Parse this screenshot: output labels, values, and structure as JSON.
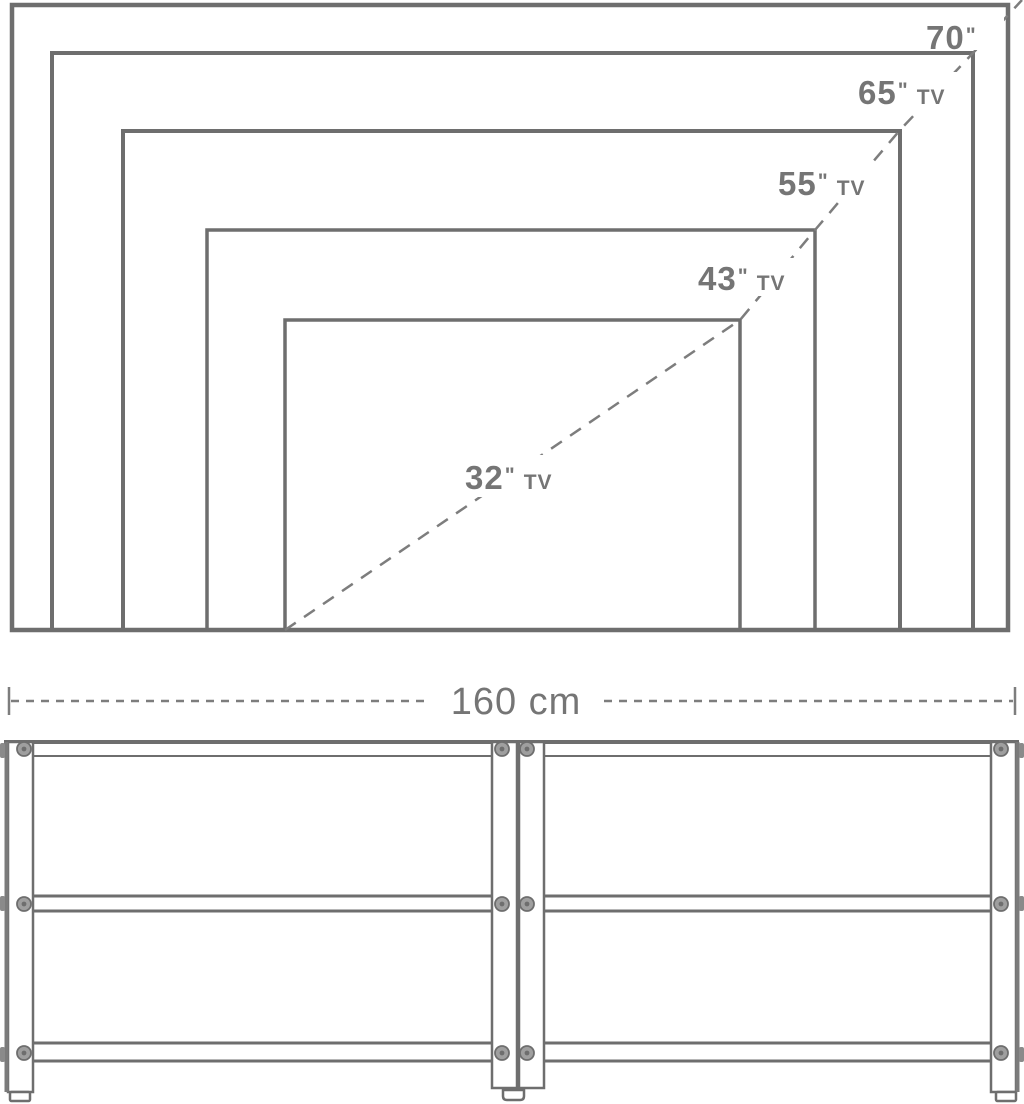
{
  "figure": {
    "title": "tv-stand-size-compatibility-diagram",
    "colors": {
      "line": "#6e6e6e",
      "dash": "#7d7d7d",
      "text": "#757575",
      "background": "#ffffff"
    },
    "tv_size_chart": {
      "labels": [
        {
          "size": "70",
          "quote": "\"",
          "suffix": ""
        },
        {
          "size": "65",
          "quote": "\"",
          "suffix": "TV"
        },
        {
          "size": "55",
          "quote": "\"",
          "suffix": "TV"
        },
        {
          "size": "43",
          "quote": "\"",
          "suffix": "TV"
        },
        {
          "size": "32",
          "quote": "\"",
          "suffix": "TV"
        }
      ]
    },
    "stand": {
      "width_label": "160 cm"
    }
  }
}
